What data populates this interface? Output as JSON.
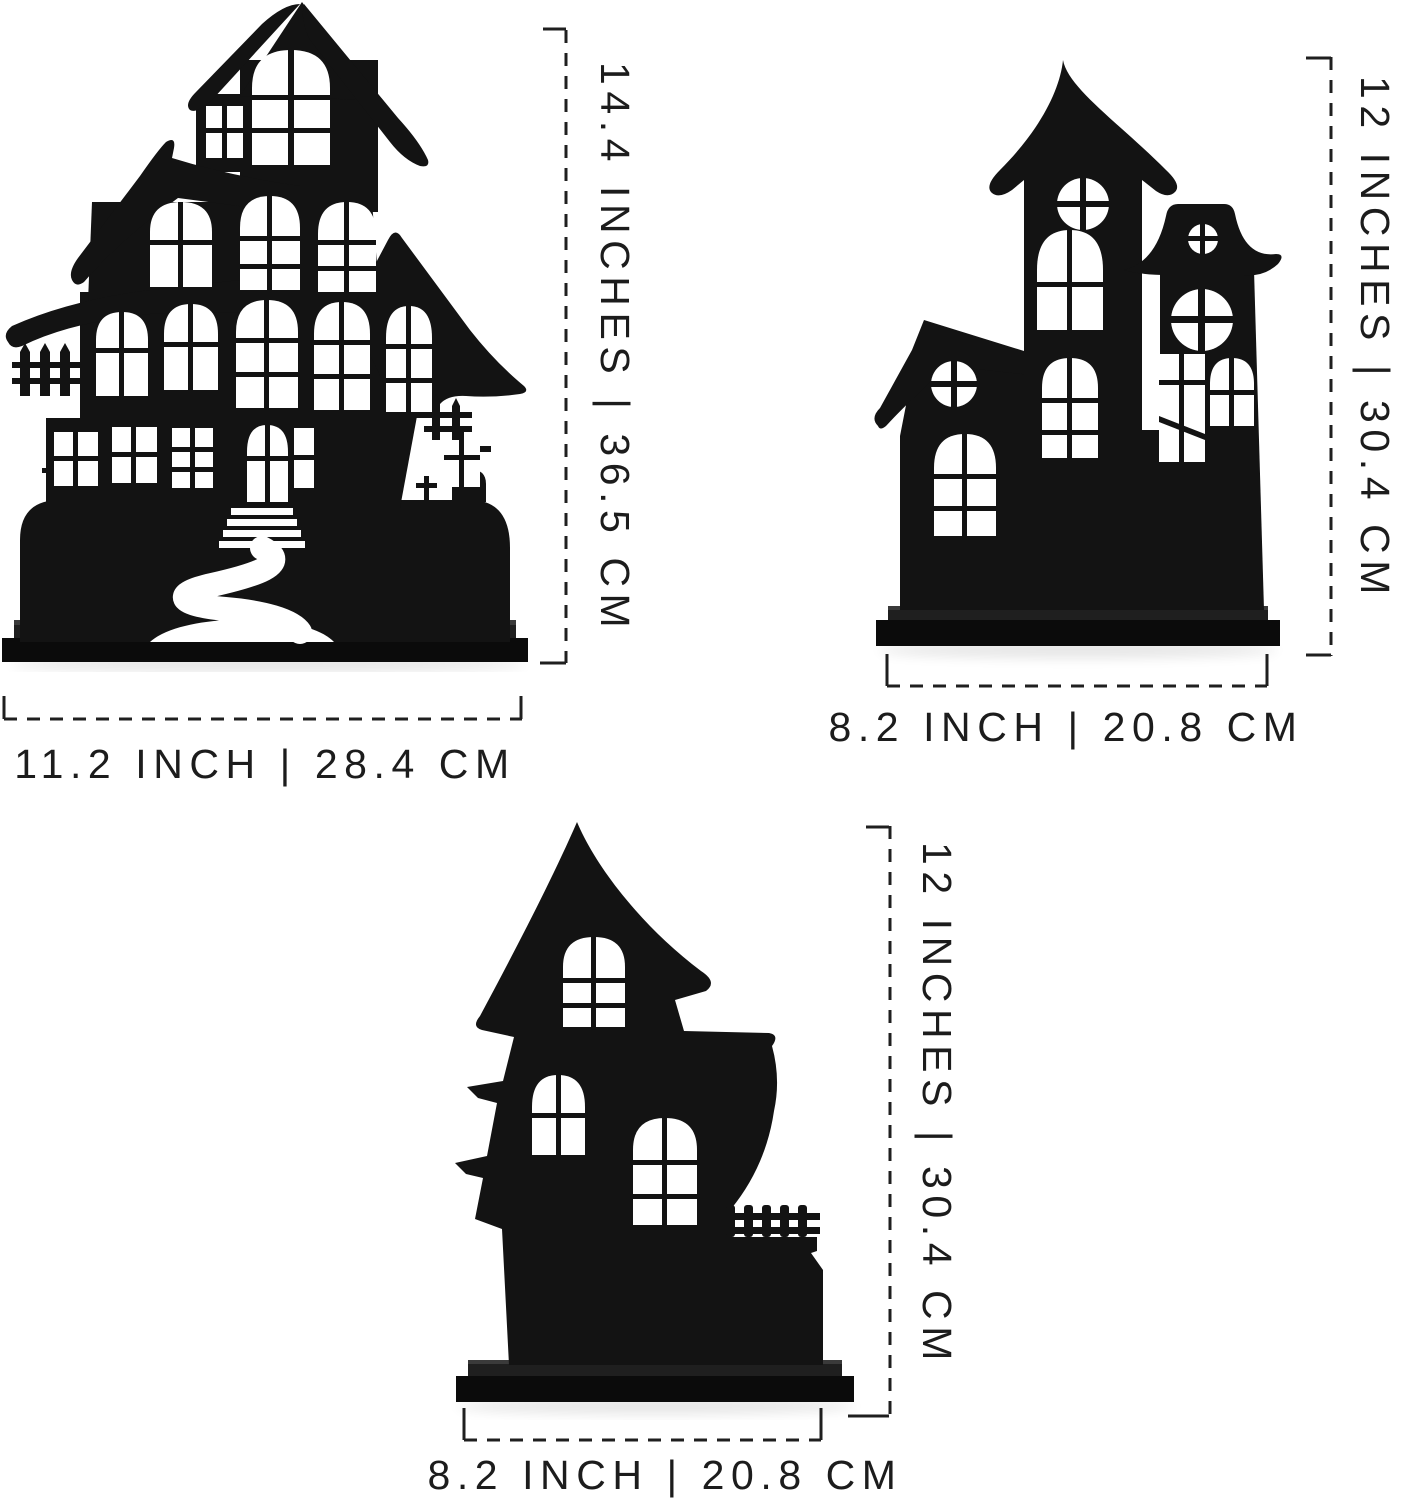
{
  "figure": {
    "type": "product-dimension-diagram",
    "background": "#ffffff",
    "silhouette_color": "#131313",
    "dash_line_color": "#1f1f1f",
    "label_text_color": "#1c1c1c"
  },
  "products": [
    {
      "name": "haunted-house-large",
      "height_label": "14.4 INCHES | 36.5 CM",
      "width_label": "11.2 INCH | 28.4 CM"
    },
    {
      "name": "haunted-house-castle",
      "height_label": "12 INCHES | 30.4 CM",
      "width_label": "8.2 INCH | 20.8 CM"
    },
    {
      "name": "haunted-house-cottage",
      "height_label": "12 INCHES | 30.4 CM",
      "width_label": "8.2 INCH | 20.8 CM"
    }
  ]
}
